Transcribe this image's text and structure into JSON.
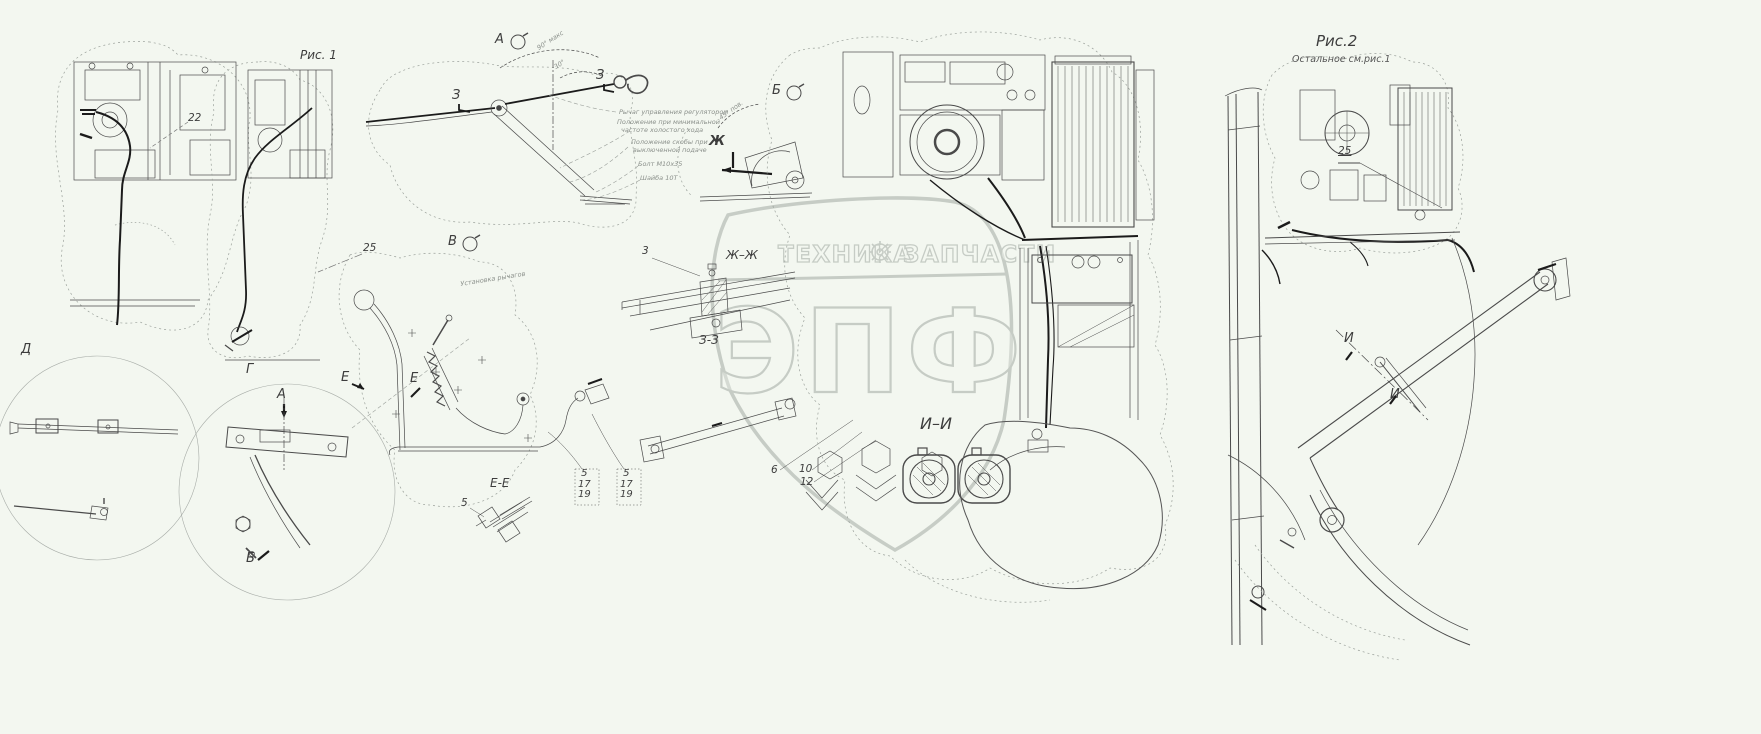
{
  "palette": {
    "background": "#f3f7f0",
    "line": "#4a4a4a",
    "bold_line": "#1b1b1b",
    "dotted_outline": "#9aa09a",
    "annotation_text": "#8b908b",
    "watermark": "#b3bab3"
  },
  "watermark": {
    "band_left": "ТЕХНИКА",
    "band_right": "ЗАПЧАСТИ",
    "gear_icon": "gear",
    "big_letters": "ЭПФ"
  },
  "fig1": {
    "caption": "Рис. 1",
    "callouts": {
      "c22": "22",
      "c25": "25",
      "c3": "3",
      "c5": "5",
      "c6": "6",
      "c10": "10",
      "c12": "12"
    },
    "stack1": [
      "5",
      "17",
      "19"
    ],
    "stack2": [
      "5",
      "17",
      "19"
    ],
    "view_markers": {
      "A": "А",
      "B": "Б",
      "V": "В",
      "E1": "Е",
      "E2": "Е",
      "Zh": "Ж",
      "Z1": "З",
      "Z2": "З",
      "G": "Г",
      "D": "Д",
      "A_cut": "А",
      "B_cut": "Б"
    },
    "section_labels": {
      "EE": "Е-Е",
      "ZhZh": "Ж–Ж",
      "ZZ": "З-З",
      "II": "И–И"
    },
    "annotations": {
      "angle90": "90° макс",
      "angle30": "30°",
      "angle45": "45° пов.",
      "lever": "Рычаг управления регулятором",
      "pos_min_1": "Положение при минимальной",
      "pos_min_2": "частоте холостого хода",
      "pos_off_1": "Положение скобы при",
      "pos_off_2": "выключенной подаче",
      "bolt": "Болт М10х35",
      "washer": "Шайба 10Т",
      "install": "Установка рычагов"
    }
  },
  "fig2": {
    "caption": "Рис.2",
    "subcaption": "Остальное см.рис.1",
    "callout25": "25",
    "cut_markers": {
      "I1": "И",
      "I2": "И"
    }
  }
}
